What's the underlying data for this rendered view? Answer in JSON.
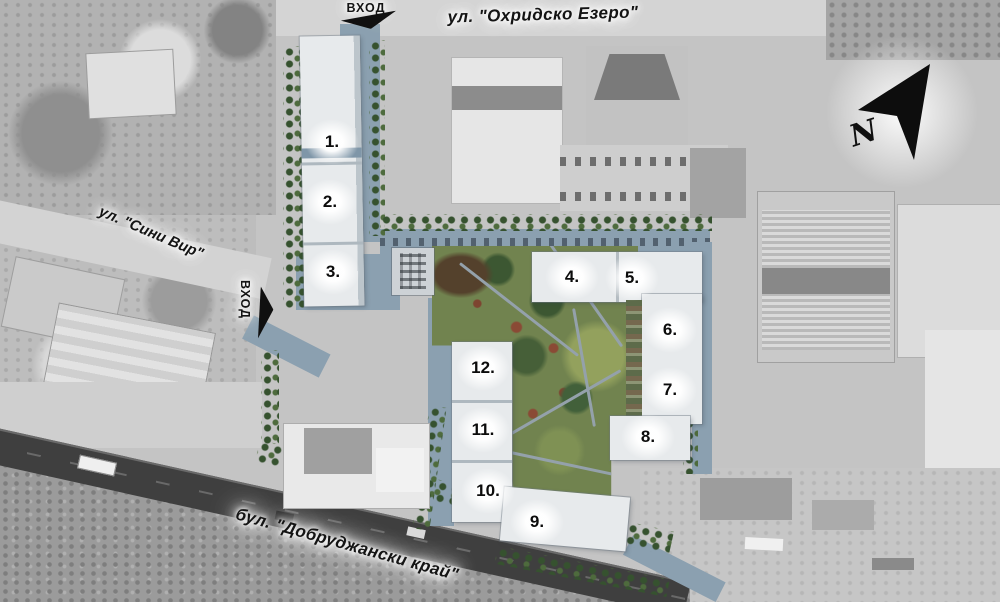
{
  "map": {
    "streets": {
      "top": "ул. \"Охридско Езеро\"",
      "left": "ул. \"Сини Вир\"",
      "bottom": "бул. \"Добруджански край\""
    },
    "entrances": {
      "top": "ВХОД",
      "left": "ВХОД"
    },
    "compass": {
      "label": "N"
    },
    "buildings": [
      {
        "label": "1."
      },
      {
        "label": "2."
      },
      {
        "label": "3."
      },
      {
        "label": "4."
      },
      {
        "label": "5."
      },
      {
        "label": "6."
      },
      {
        "label": "7."
      },
      {
        "label": "8."
      },
      {
        "label": "9."
      },
      {
        "label": "10."
      },
      {
        "label": "11."
      },
      {
        "label": "12."
      }
    ],
    "colors": {
      "site_road": "#8ba0b0",
      "building": "#e7eaec",
      "park": "#71834f",
      "trees": "#36522f",
      "boulevard": "#3f3f3f",
      "label_text": "#141414"
    }
  }
}
